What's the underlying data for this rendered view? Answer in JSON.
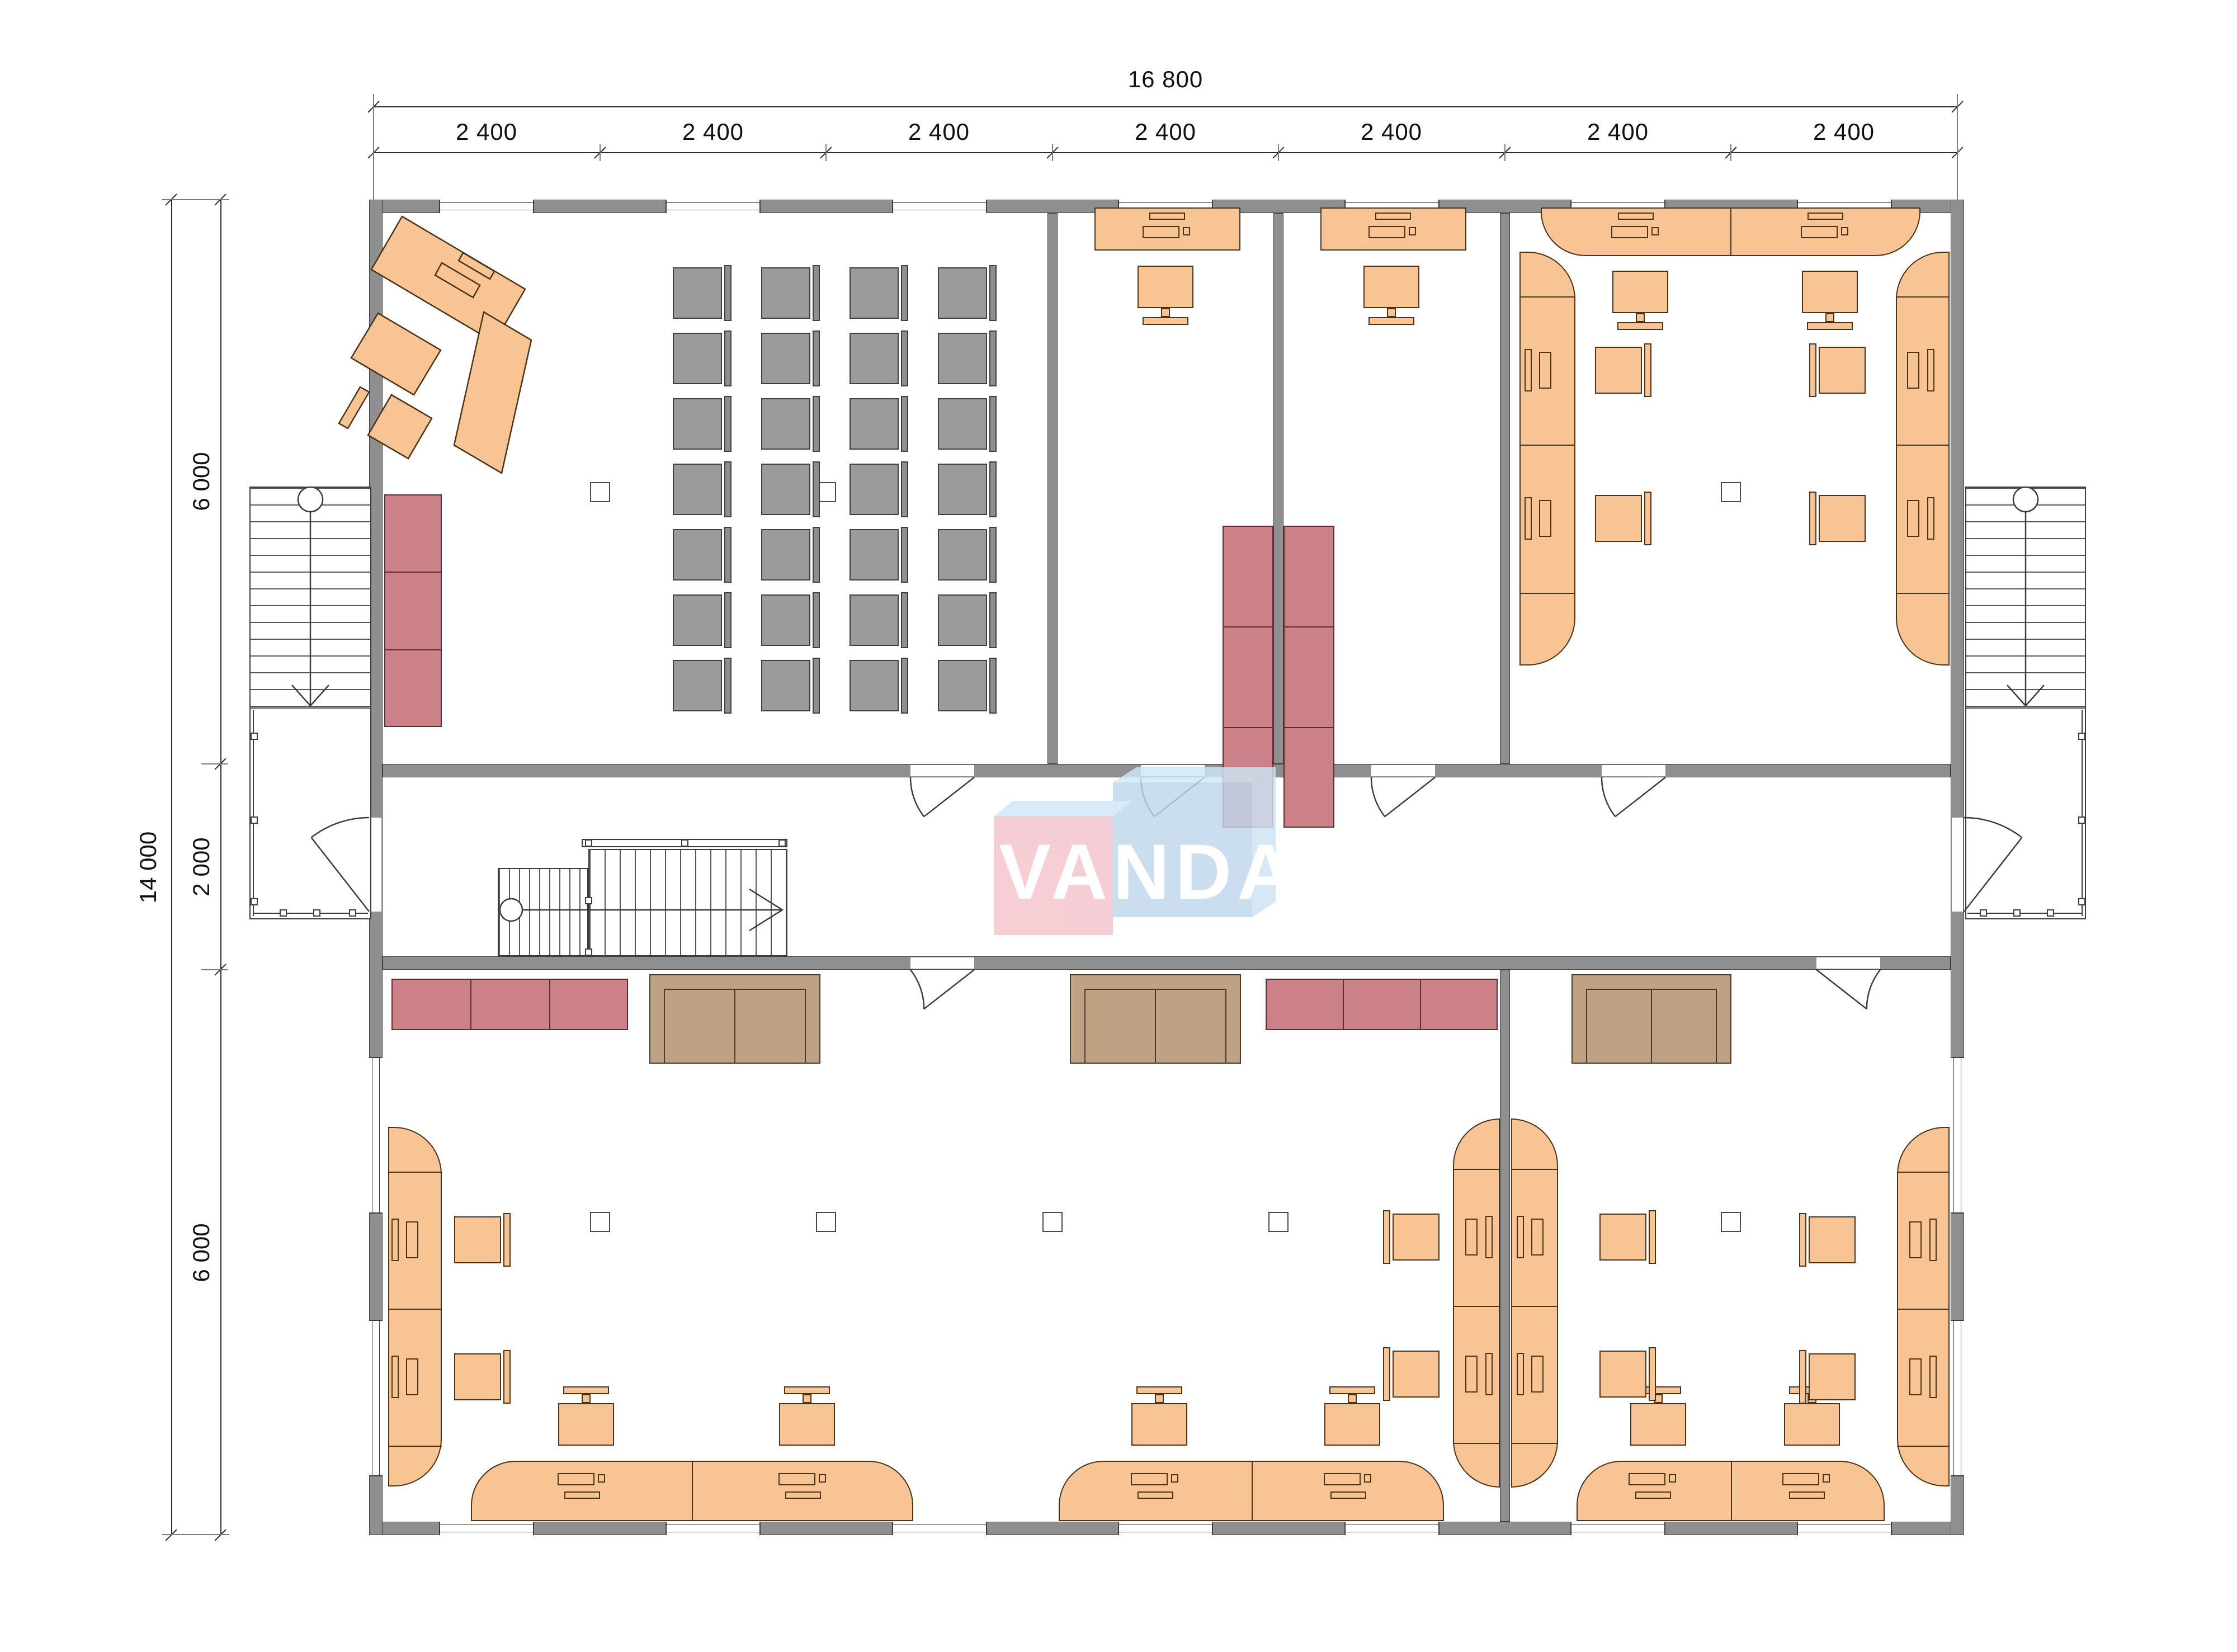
{
  "drawing": {
    "watermark": "VANDA",
    "dimensions": {
      "total_width_label": "16 800",
      "bay_labels": [
        "2 400",
        "2 400",
        "2 400",
        "2 400",
        "2 400",
        "2 400",
        "2 400"
      ],
      "total_height_label": "14 000",
      "upper_rooms_label": "6 000",
      "corridor_label": "2 000",
      "lower_rooms_label": "6 000"
    }
  }
}
